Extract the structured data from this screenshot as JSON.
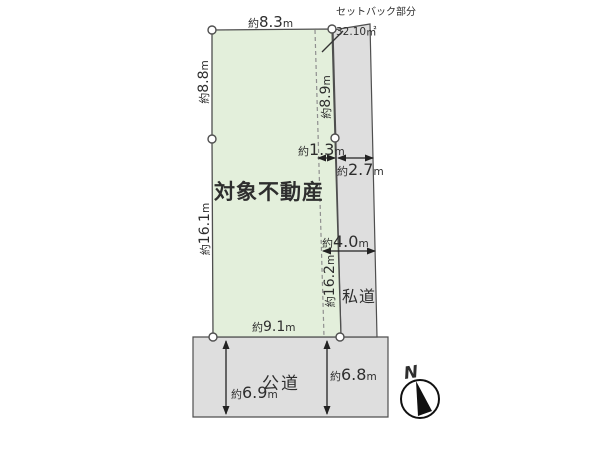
{
  "title": "対象不動産",
  "annotations": {
    "setback_caption": "セットバック部分",
    "setback_area": "32.10㎡",
    "private_road": "私道",
    "public_road": "公道",
    "compass_north": "N"
  },
  "dimensions": {
    "top_width": {
      "prefix": "約",
      "value": "8.3",
      "unit": "m"
    },
    "left_upper": {
      "prefix": "約",
      "value": "8.8",
      "unit": "m"
    },
    "left_lower": {
      "prefix": "約",
      "value": "16.1",
      "unit": "m"
    },
    "right_upper": {
      "prefix": "約",
      "value": "8.9",
      "unit": "m"
    },
    "right_lower": {
      "prefix": "約",
      "value": "16.2",
      "unit": "m"
    },
    "bottom_width": {
      "prefix": "約",
      "value": "9.1",
      "unit": "m"
    },
    "setback_width": {
      "prefix": "約",
      "value": "1.3",
      "unit": "m"
    },
    "private_road_width": {
      "prefix": "約",
      "value": "2.7",
      "unit": "m"
    },
    "total_road_width": {
      "prefix": "約",
      "value": "4.0",
      "unit": "m"
    },
    "public_road_width_left": {
      "prefix": "約",
      "value": "6.9",
      "unit": "m"
    },
    "public_road_width_right": {
      "prefix": "約",
      "value": "6.8",
      "unit": "m"
    }
  },
  "colors": {
    "plot_fill": "#e3efdb",
    "road_fill": "#dedede",
    "outline": "#4f4f4f",
    "dashed_line": "#8f8f8f",
    "arrow": "#222222",
    "text": "#2e2e2e"
  }
}
